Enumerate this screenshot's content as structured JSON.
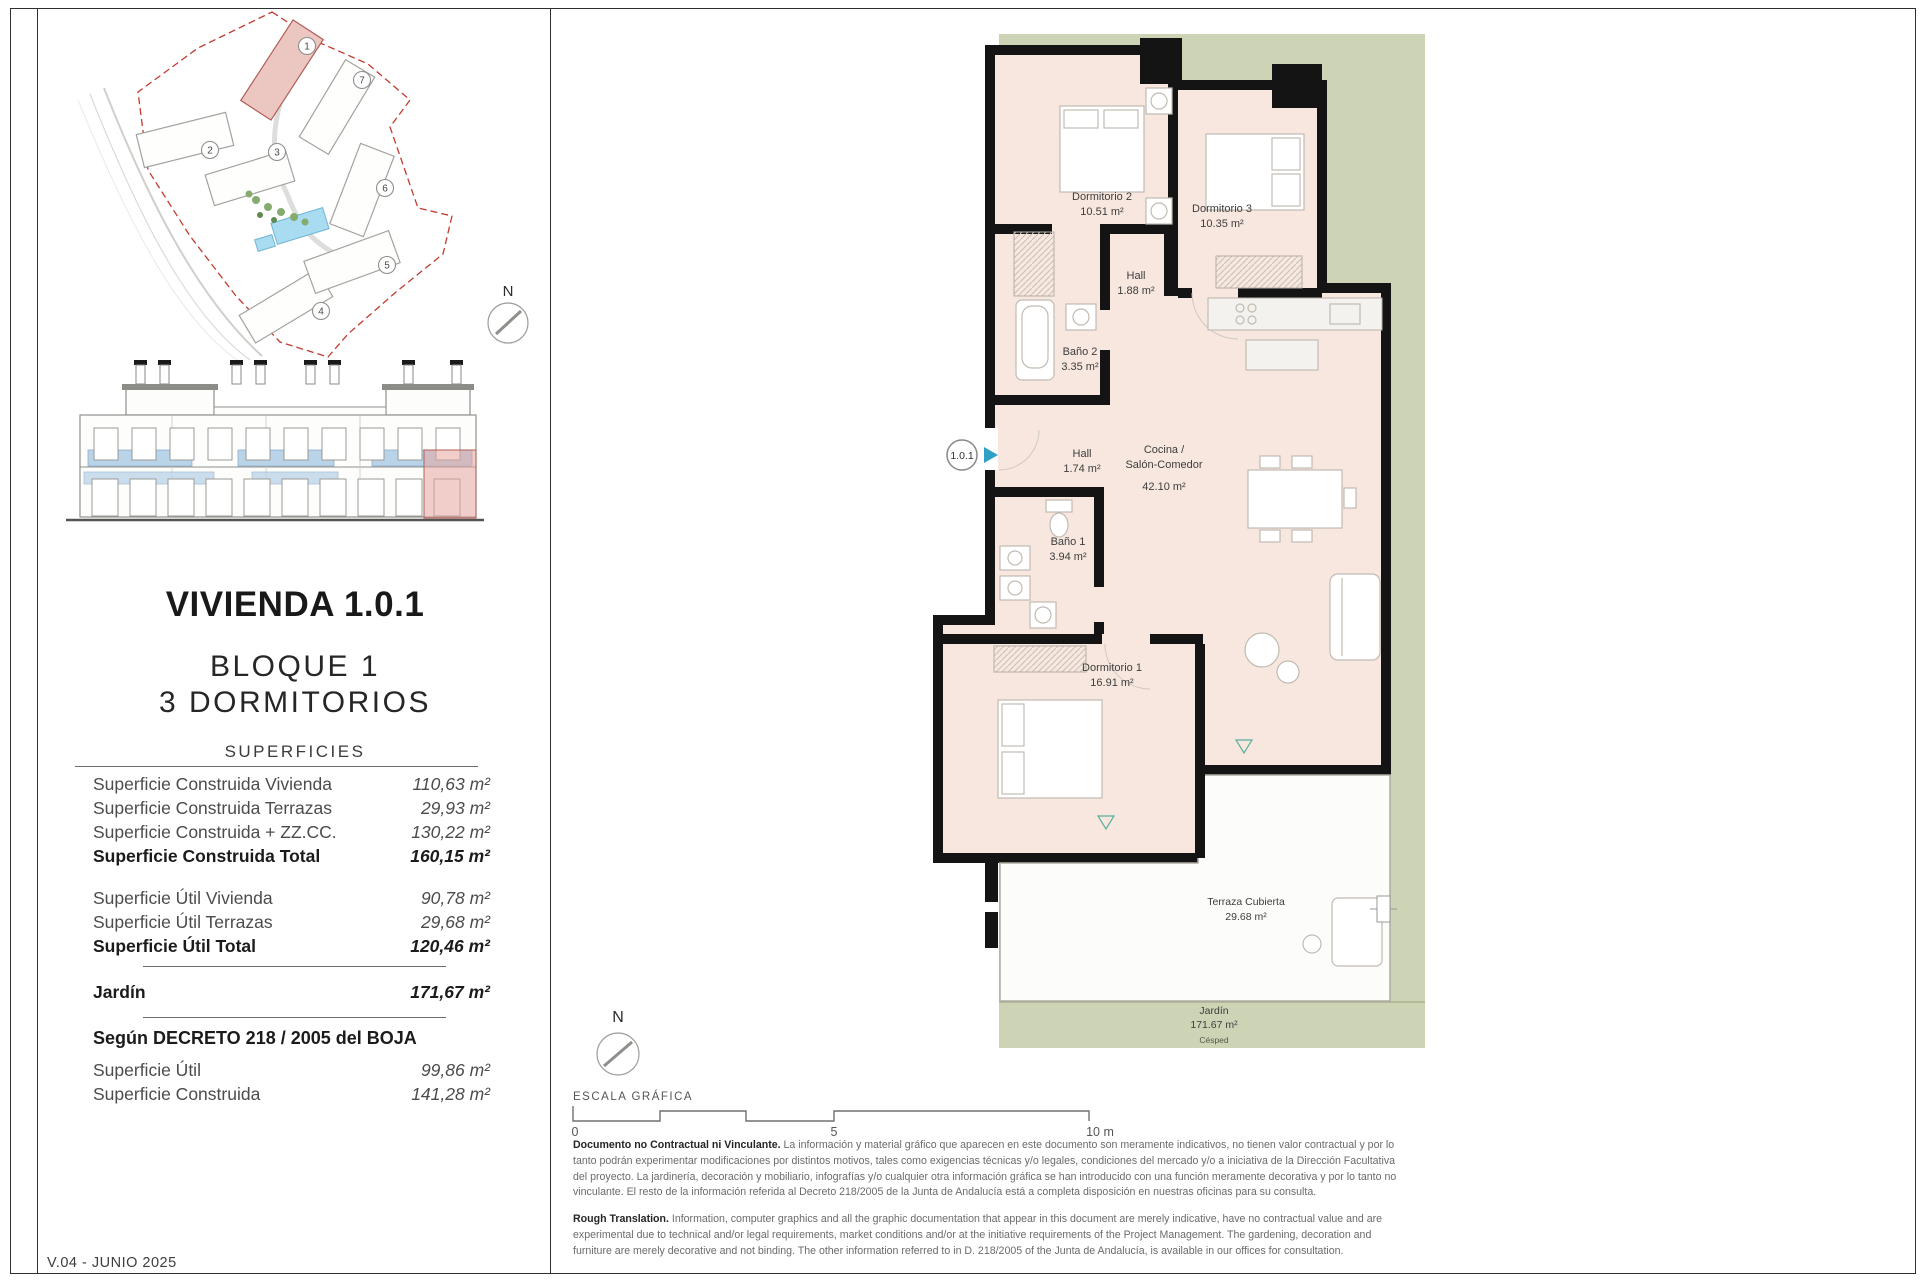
{
  "page": {
    "version": "V.04 - JUNIO 2025"
  },
  "site_plan": {
    "north": "N",
    "buildings": [
      "1",
      "2",
      "3",
      "4",
      "5",
      "6",
      "7"
    ]
  },
  "title_block": {
    "title": "VIVIENDA 1.0.1",
    "block": "BLOQUE 1",
    "bedrooms": "3 DORMITORIOS",
    "surfaces_header": "SUPERFICIES"
  },
  "surfaces": {
    "rows_construida": [
      {
        "label": "Superficie Construida Vivienda",
        "value": "110,63 m²"
      },
      {
        "label": "Superficie Construida Terrazas",
        "value": "29,93 m²"
      },
      {
        "label": "Superficie Construida + ZZ.CC.",
        "value": "130,22 m²"
      },
      {
        "label": "Superficie Construida Total",
        "value": "160,15 m²"
      }
    ],
    "rows_util": [
      {
        "label": "Superficie Útil Vivienda",
        "value": "90,78 m²"
      },
      {
        "label": "Superficie Útil Terrazas",
        "value": "29,68 m²"
      },
      {
        "label": "Superficie Útil Total",
        "value": "120,46 m²"
      }
    ],
    "jardin": {
      "label": "Jardín",
      "value": "171,67 m²"
    },
    "decreto_header": "Según DECRETO 218 / 2005 del BOJA",
    "rows_decreto": [
      {
        "label": "Superficie Útil",
        "value": "99,86 m²"
      },
      {
        "label": "Superficie Construida",
        "value": "141,28 m²"
      }
    ]
  },
  "floor_plan": {
    "unit_marker": "1.0.1",
    "north": "N",
    "accent_color": "#2f9fc6",
    "floor_color": "#f7e7df",
    "garden_color": "#cdd4b5",
    "rooms": [
      {
        "name": "Dormitorio 2",
        "area": "10.51 m²"
      },
      {
        "name": "Dormitorio 3",
        "area": "10.35 m²"
      },
      {
        "name": "Hall",
        "area": "1.88 m²"
      },
      {
        "name": "Baño 2",
        "area": "3.35 m²"
      },
      {
        "name": "Hall",
        "area": "1.74 m²"
      },
      {
        "name": "Cocina /",
        "name2": "Salón-Comedor",
        "area": "42.10 m²"
      },
      {
        "name": "Baño 1",
        "area": "3.94 m²"
      },
      {
        "name": "Dormitorio 1",
        "area": "16.91 m²"
      },
      {
        "name": "Terraza Cubierta",
        "area": "29.68 m²"
      },
      {
        "name": "Jardín",
        "area": "171.67 m²",
        "note": "Césped"
      }
    ]
  },
  "scale": {
    "title": "ESCALA GRÁFICA",
    "tick0": "0",
    "tick5": "5",
    "tick10": "10 m"
  },
  "disclaimer": {
    "es_lead": "Documento no Contractual ni Vinculante.",
    "es_body": " La información y material gráfico que aparecen en este documento son meramente indicativos, no tienen valor contractual y por lo tanto podrán experimentar modificaciones por distintos motivos, tales como exigencias técnicas y/o legales, condiciones del mercado y/o a iniciativa de la Dirección Facultativa del proyecto. La jardinería, decoración y mobiliario, infografías y/o cualquier otra información gráfica se han introducido con una función meramente decorativa y por lo tanto no vinculante. El resto de la información referida al Decreto 218/2005 de la Junta de Andalucía está a completa disposición en nuestras oficinas para su consulta.",
    "en_lead": "Rough Translation.",
    "en_body": " Information, computer graphics and all the graphic documentation that appear in this document are merely indicative, have no contractual value and are experimental due to technical and/or legal requirements, market conditions and/or at the initiative requirements of the Project Management. The gardening, decoration and furniture are merely decorative and not binding. The other information referred to in D. 218/2005 of the Junta de Andalucía, is available in our offices for consultation."
  }
}
